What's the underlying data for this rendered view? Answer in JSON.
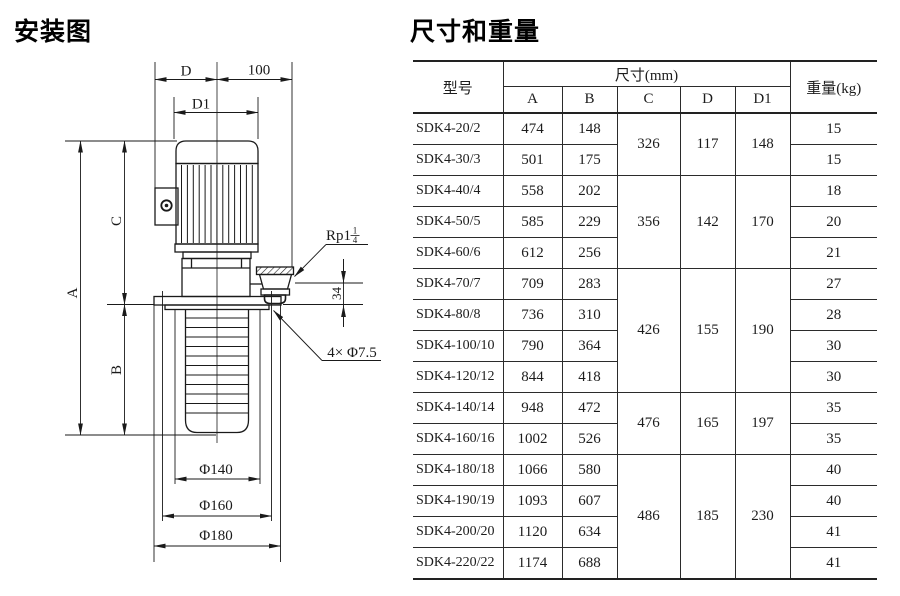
{
  "page": {
    "title_left": "安装图",
    "title_right": "尺寸和重量"
  },
  "drawing": {
    "labels": {
      "d": "D",
      "d1": "D1",
      "top_offset": "100",
      "a": "A",
      "b": "B",
      "c": "C",
      "outlet_offset": "34",
      "phi140": "Φ140",
      "phi160": "Φ160",
      "phi180": "Φ180",
      "holes": "4× Φ7.5",
      "thread_base": "Rp1",
      "thread_num": "1",
      "thread_den": "4"
    }
  },
  "table": {
    "header": {
      "model": "型号",
      "size": "尺寸(mm)",
      "a": "A",
      "b": "B",
      "c": "C",
      "d": "D",
      "d1": "D1",
      "weight": "重量(kg)"
    },
    "rows": [
      {
        "model": "SDK4-20/2",
        "a": "474",
        "b": "148",
        "weight": "15"
      },
      {
        "model": "SDK4-30/3",
        "a": "501",
        "b": "175",
        "weight": "15"
      },
      {
        "model": "SDK4-40/4",
        "a": "558",
        "b": "202",
        "weight": "18"
      },
      {
        "model": "SDK4-50/5",
        "a": "585",
        "b": "229",
        "weight": "20"
      },
      {
        "model": "SDK4-60/6",
        "a": "612",
        "b": "256",
        "weight": "21"
      },
      {
        "model": "SDK4-70/7",
        "a": "709",
        "b": "283",
        "weight": "27"
      },
      {
        "model": "SDK4-80/8",
        "a": "736",
        "b": "310",
        "weight": "28"
      },
      {
        "model": "SDK4-100/10",
        "a": "790",
        "b": "364",
        "weight": "30"
      },
      {
        "model": "SDK4-120/12",
        "a": "844",
        "b": "418",
        "weight": "30"
      },
      {
        "model": "SDK4-140/14",
        "a": "948",
        "b": "472",
        "weight": "35"
      },
      {
        "model": "SDK4-160/16",
        "a": "1002",
        "b": "526",
        "weight": "35"
      },
      {
        "model": "SDK4-180/18",
        "a": "1066",
        "b": "580",
        "weight": "40"
      },
      {
        "model": "SDK4-190/19",
        "a": "1093",
        "b": "607",
        "weight": "40"
      },
      {
        "model": "SDK4-200/20",
        "a": "1120",
        "b": "634",
        "weight": "41"
      },
      {
        "model": "SDK4-220/22",
        "a": "1174",
        "b": "688",
        "weight": "41"
      }
    ],
    "groups": [
      {
        "start": 0,
        "span": 2,
        "c": "326",
        "d": "117",
        "d1": "148"
      },
      {
        "start": 2,
        "span": 3,
        "c": "356",
        "d": "142",
        "d1": "170"
      },
      {
        "start": 5,
        "span": 4,
        "c": "426",
        "d": "155",
        "d1": "190"
      },
      {
        "start": 9,
        "span": 2,
        "c": "476",
        "d": "165",
        "d1": "197"
      },
      {
        "start": 11,
        "span": 4,
        "c": "486",
        "d": "185",
        "d1": "230"
      }
    ]
  }
}
